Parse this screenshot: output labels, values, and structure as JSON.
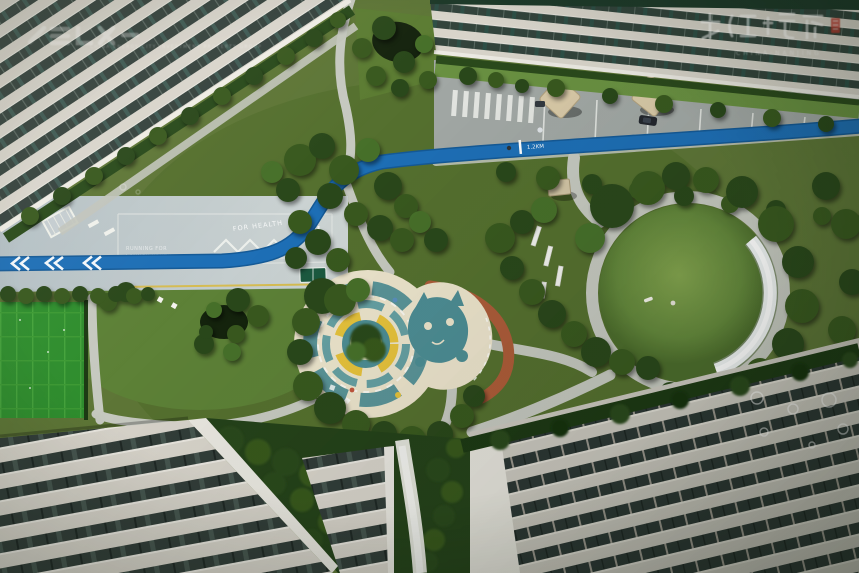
{
  "markings": {
    "for_health": "FOR HEALTH",
    "plaza_line1": "RUNNING FOR",
    "plaza_line2": "LAUNCH YOUTH",
    "distance_marker": "1.2KM"
  },
  "watermark_top_left": {
    "caption": "CHINA ENERGY CITY INVESTMENT PROPERTY GROUP"
  },
  "watermark_top_right": {
    "caption": "CHINA·NANJING"
  },
  "colors": {
    "track_blue": "#1a67ae",
    "plaza_concrete": "#bdc9cf",
    "playground_cream": "#ece4cc",
    "playground_teal": "#4d8d94",
    "playground_yellow": "#e6c23c",
    "orange_path": "#ad5c39",
    "turf_green": "#2f8e2e",
    "seal_red": "#bf3a2d"
  }
}
